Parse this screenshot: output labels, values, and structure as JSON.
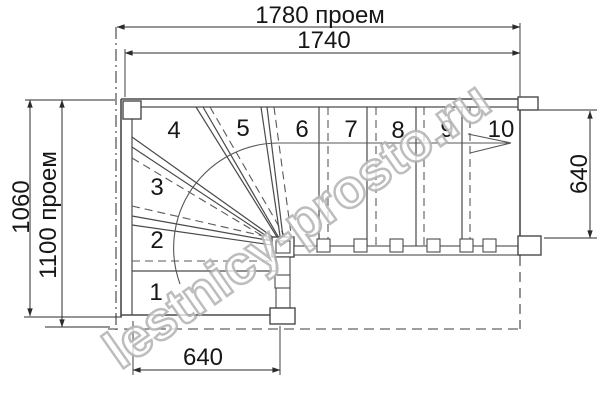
{
  "watermark": {
    "text": "lestnicy-prosto.ru"
  },
  "plan": {
    "steps": [
      "1",
      "2",
      "3",
      "4",
      "5",
      "6",
      "7",
      "8",
      "9",
      "10"
    ],
    "dimensions": {
      "top_opening": "1780 проем",
      "top_stair": "1740",
      "left_height": "1060",
      "left_opening": "1100 проем",
      "right_width": "640",
      "bottom_width": "640"
    }
  },
  "colors": {
    "drawing_line": "#4a4a4a",
    "dimension_line": "#2b2b2b",
    "label_text": "#161616",
    "watermark_outline": "#b2b2b2",
    "background": "#ffffff"
  }
}
